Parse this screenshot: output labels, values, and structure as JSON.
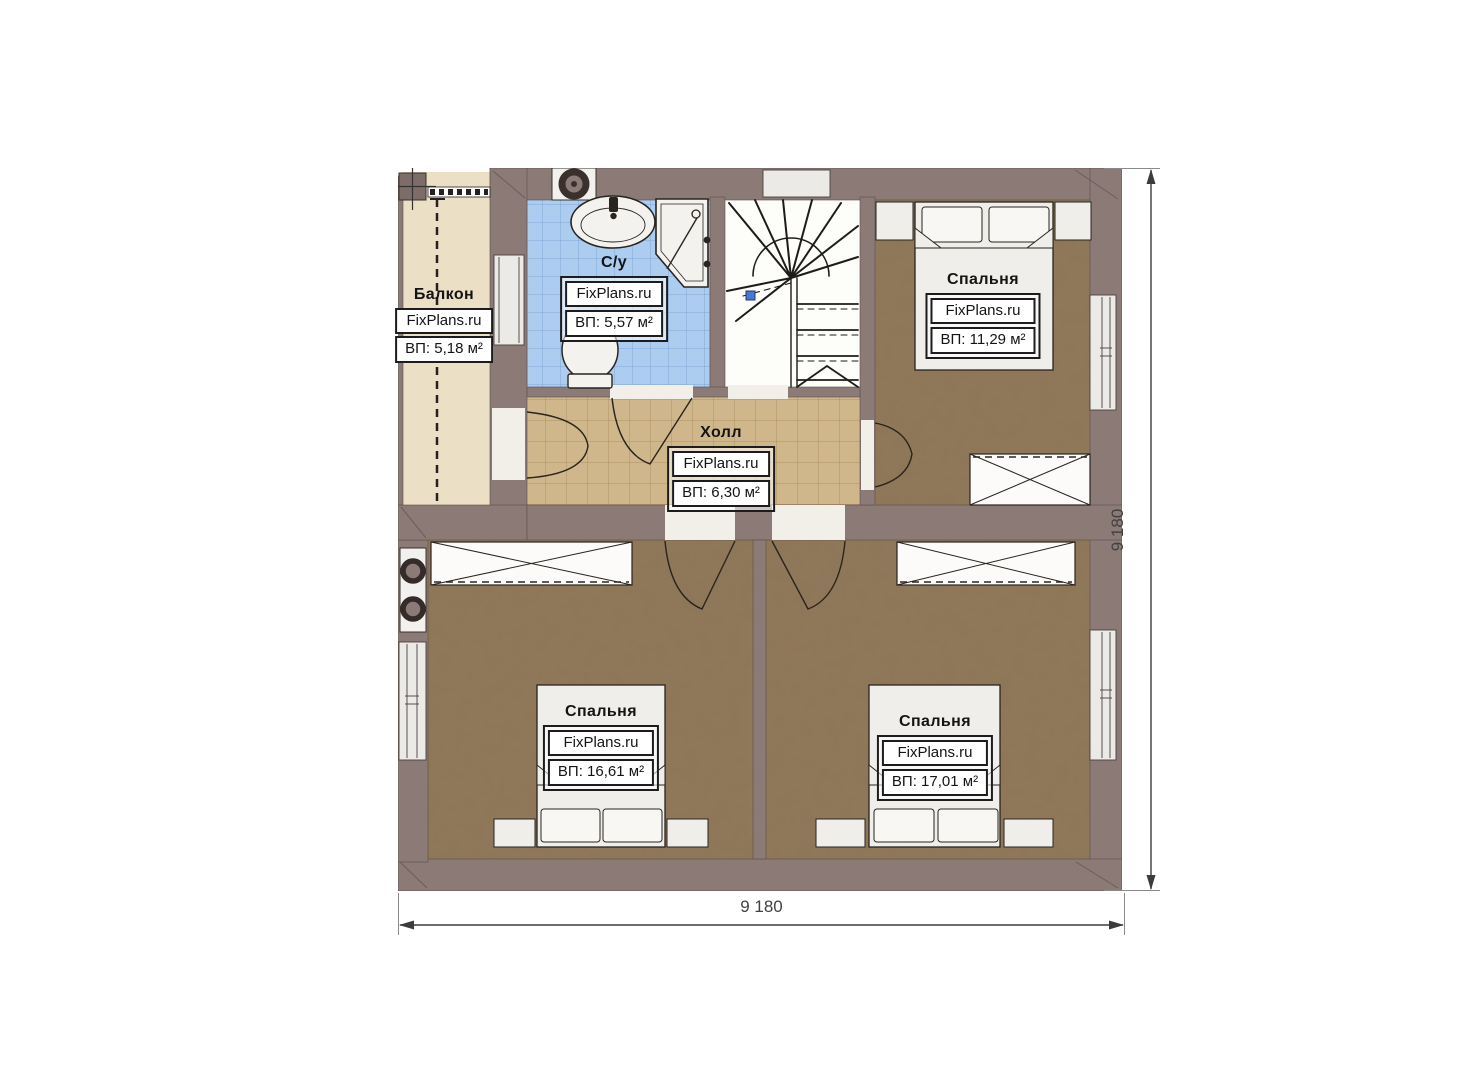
{
  "watermark": "FixPlans.ru",
  "rooms": [
    {
      "id": "balcony",
      "name": "Балкон",
      "area": "ВП: 5,18 м²"
    },
    {
      "id": "bathroom",
      "name": "С/у",
      "area": "ВП: 5,57 м²"
    },
    {
      "id": "hall",
      "name": "Холл",
      "area": "ВП: 6,30 м²"
    },
    {
      "id": "bedroom-top",
      "name": "Спальня",
      "area": "ВП: 11,29 м²"
    },
    {
      "id": "bedroom-left",
      "name": "Спальня",
      "area": "ВП: 16,61 м²"
    },
    {
      "id": "bedroom-right",
      "name": "Спальня",
      "area": "ВП: 17,01 м²"
    }
  ],
  "dimensions": {
    "bottom": "9 180",
    "right": "9 180"
  },
  "colors": {
    "wall": "#8c7a77",
    "bedroom_floor": "#8e7557",
    "hall_floor": "#d0b78b",
    "bathroom_floor": "#adcdf0",
    "balcony_floor": "#ebe0c6",
    "fixture": "#f2f1ed",
    "stair_marker": "#4a78d0"
  }
}
